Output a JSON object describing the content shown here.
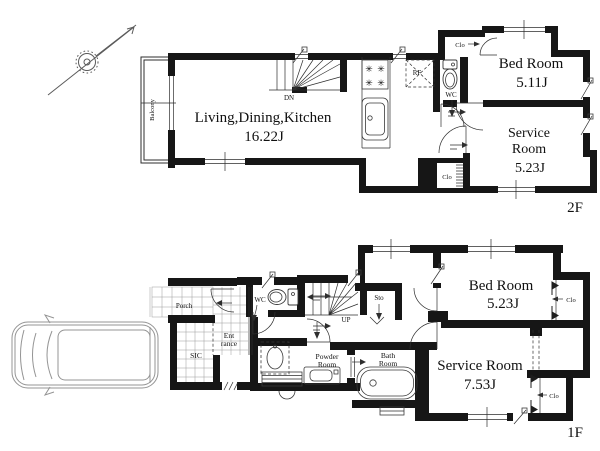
{
  "floor_2f": {
    "floor_label": "2F",
    "ldk": {
      "name": "Living,Dining,Kitchen",
      "area": "16.22J"
    },
    "bed_room": {
      "name": "Bed Room",
      "area": "5.11J"
    },
    "service_room": {
      "name_line1": "Service",
      "name_line2": "Room",
      "area": "5.23J"
    },
    "balcony": {
      "name": "Balcony"
    },
    "wc": {
      "name": "WC"
    },
    "refrigerator": {
      "abbr": "RF"
    },
    "stairs": {
      "direction_label": "DN"
    },
    "closet_top": {
      "abbr": "Clo"
    },
    "closet_bottom": {
      "abbr": "Clo"
    }
  },
  "floor_1f": {
    "floor_label": "1F",
    "bed_room": {
      "name": "Bed Room",
      "area": "5.23J"
    },
    "service_room": {
      "name": "Service Room",
      "area": "7.53J"
    },
    "porch": {
      "name": "Porch"
    },
    "entrance": {
      "name_line1": "Ent",
      "name_line2": "rance"
    },
    "shoe_closet": {
      "abbr": "SIC"
    },
    "wc": {
      "name": "WC"
    },
    "storage": {
      "abbr": "Sto"
    },
    "stairs": {
      "direction_label": "UP"
    },
    "powder_room": {
      "name_line1": "Powder",
      "name_line2": "Room"
    },
    "bath_room": {
      "name_line1": "Bath",
      "name_line2": "Room"
    },
    "closet_right": {
      "abbr": "Clo"
    },
    "closet_bottom": {
      "abbr": "Clo"
    }
  },
  "icons": {
    "stove_burner": "✳"
  },
  "colors": {
    "wall": "#161616",
    "line": "#2e2e2e",
    "tile": "#9b9b9b",
    "car_outline": "#949494",
    "compass": "#5a5a5a",
    "background": "#ffffff"
  }
}
